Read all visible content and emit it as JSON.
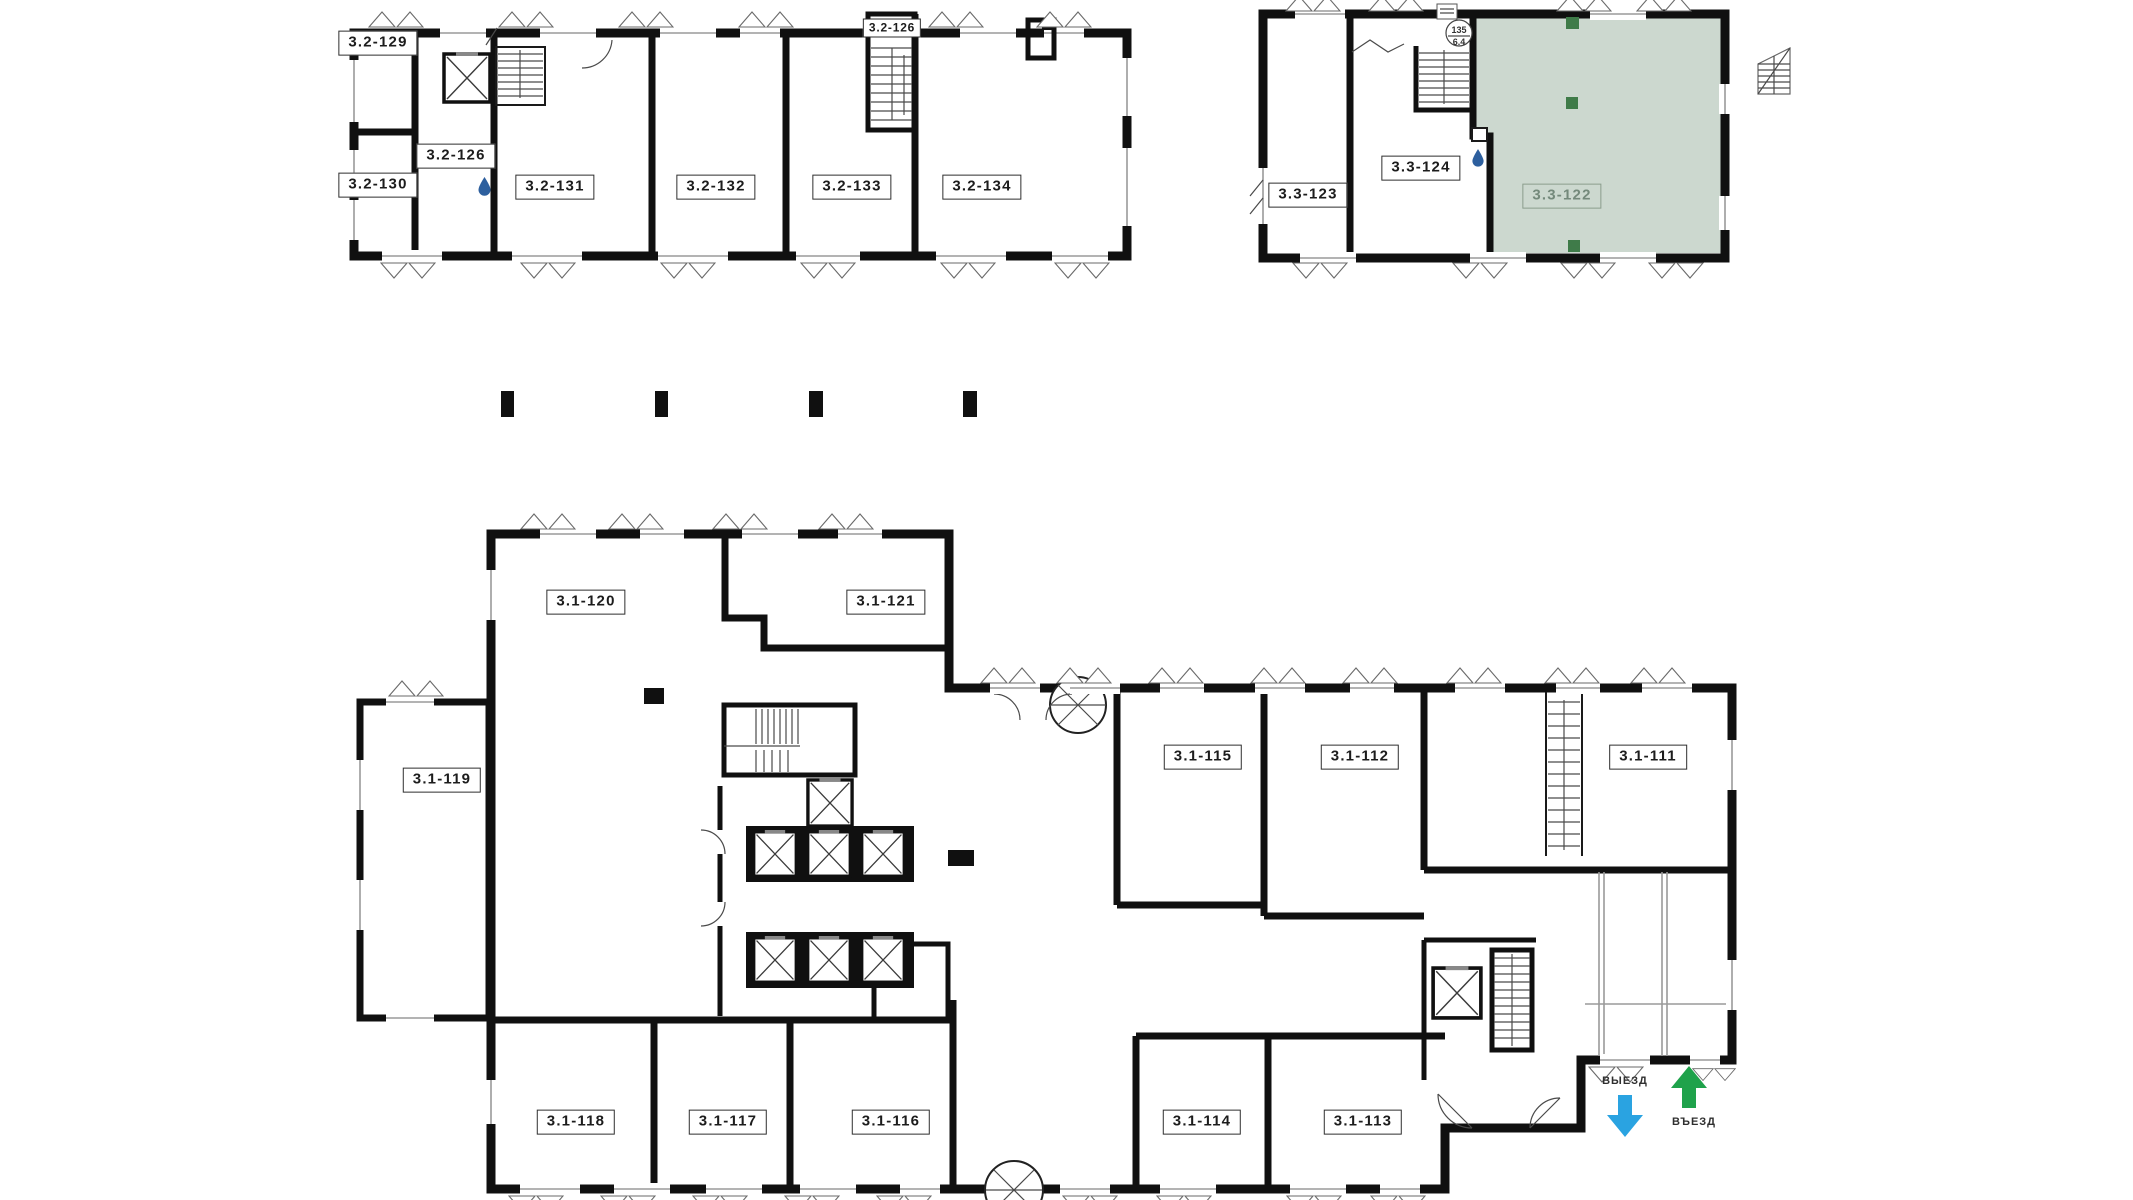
{
  "rooms": {
    "r32_129": "3.2-129",
    "r32_130": "3.2-130",
    "r32_126_lobby": "3.2-126",
    "r32_126_stair": "3.2-126",
    "r32_131": "3.2-131",
    "r32_132": "3.2-132",
    "r32_133": "3.2-133",
    "r32_134": "3.2-134",
    "r33_123": "3.3-123",
    "r33_124": "3.3-124",
    "r33_122": "3.3-122",
    "r31_119": "3.1-119",
    "r31_120": "3.1-120",
    "r31_121": "3.1-121",
    "r31_111": "3.1-111",
    "r31_112": "3.1-112",
    "r31_113": "3.1-113",
    "r31_114": "3.1-114",
    "r31_115": "3.1-115",
    "r31_116": "3.1-116",
    "r31_117": "3.1-117",
    "r31_118": "3.1-118"
  },
  "selected_room": "3.3-122",
  "stair_badge": {
    "top": "135",
    "bottom": "6.4"
  },
  "arrows": {
    "exit_label": "ВЫЕЗД",
    "enter_label": "ВЪЕЗД"
  },
  "colors": {
    "wall": "#101010",
    "selected_fill": "#ccd8cf",
    "selected_text": "#74897b",
    "selected_border": "#8a9d8c",
    "marker": "#3f7b49",
    "exit_arrow": "#2aa3e1",
    "enter_arrow": "#1fa24b",
    "drop": "#2d5f9e"
  }
}
